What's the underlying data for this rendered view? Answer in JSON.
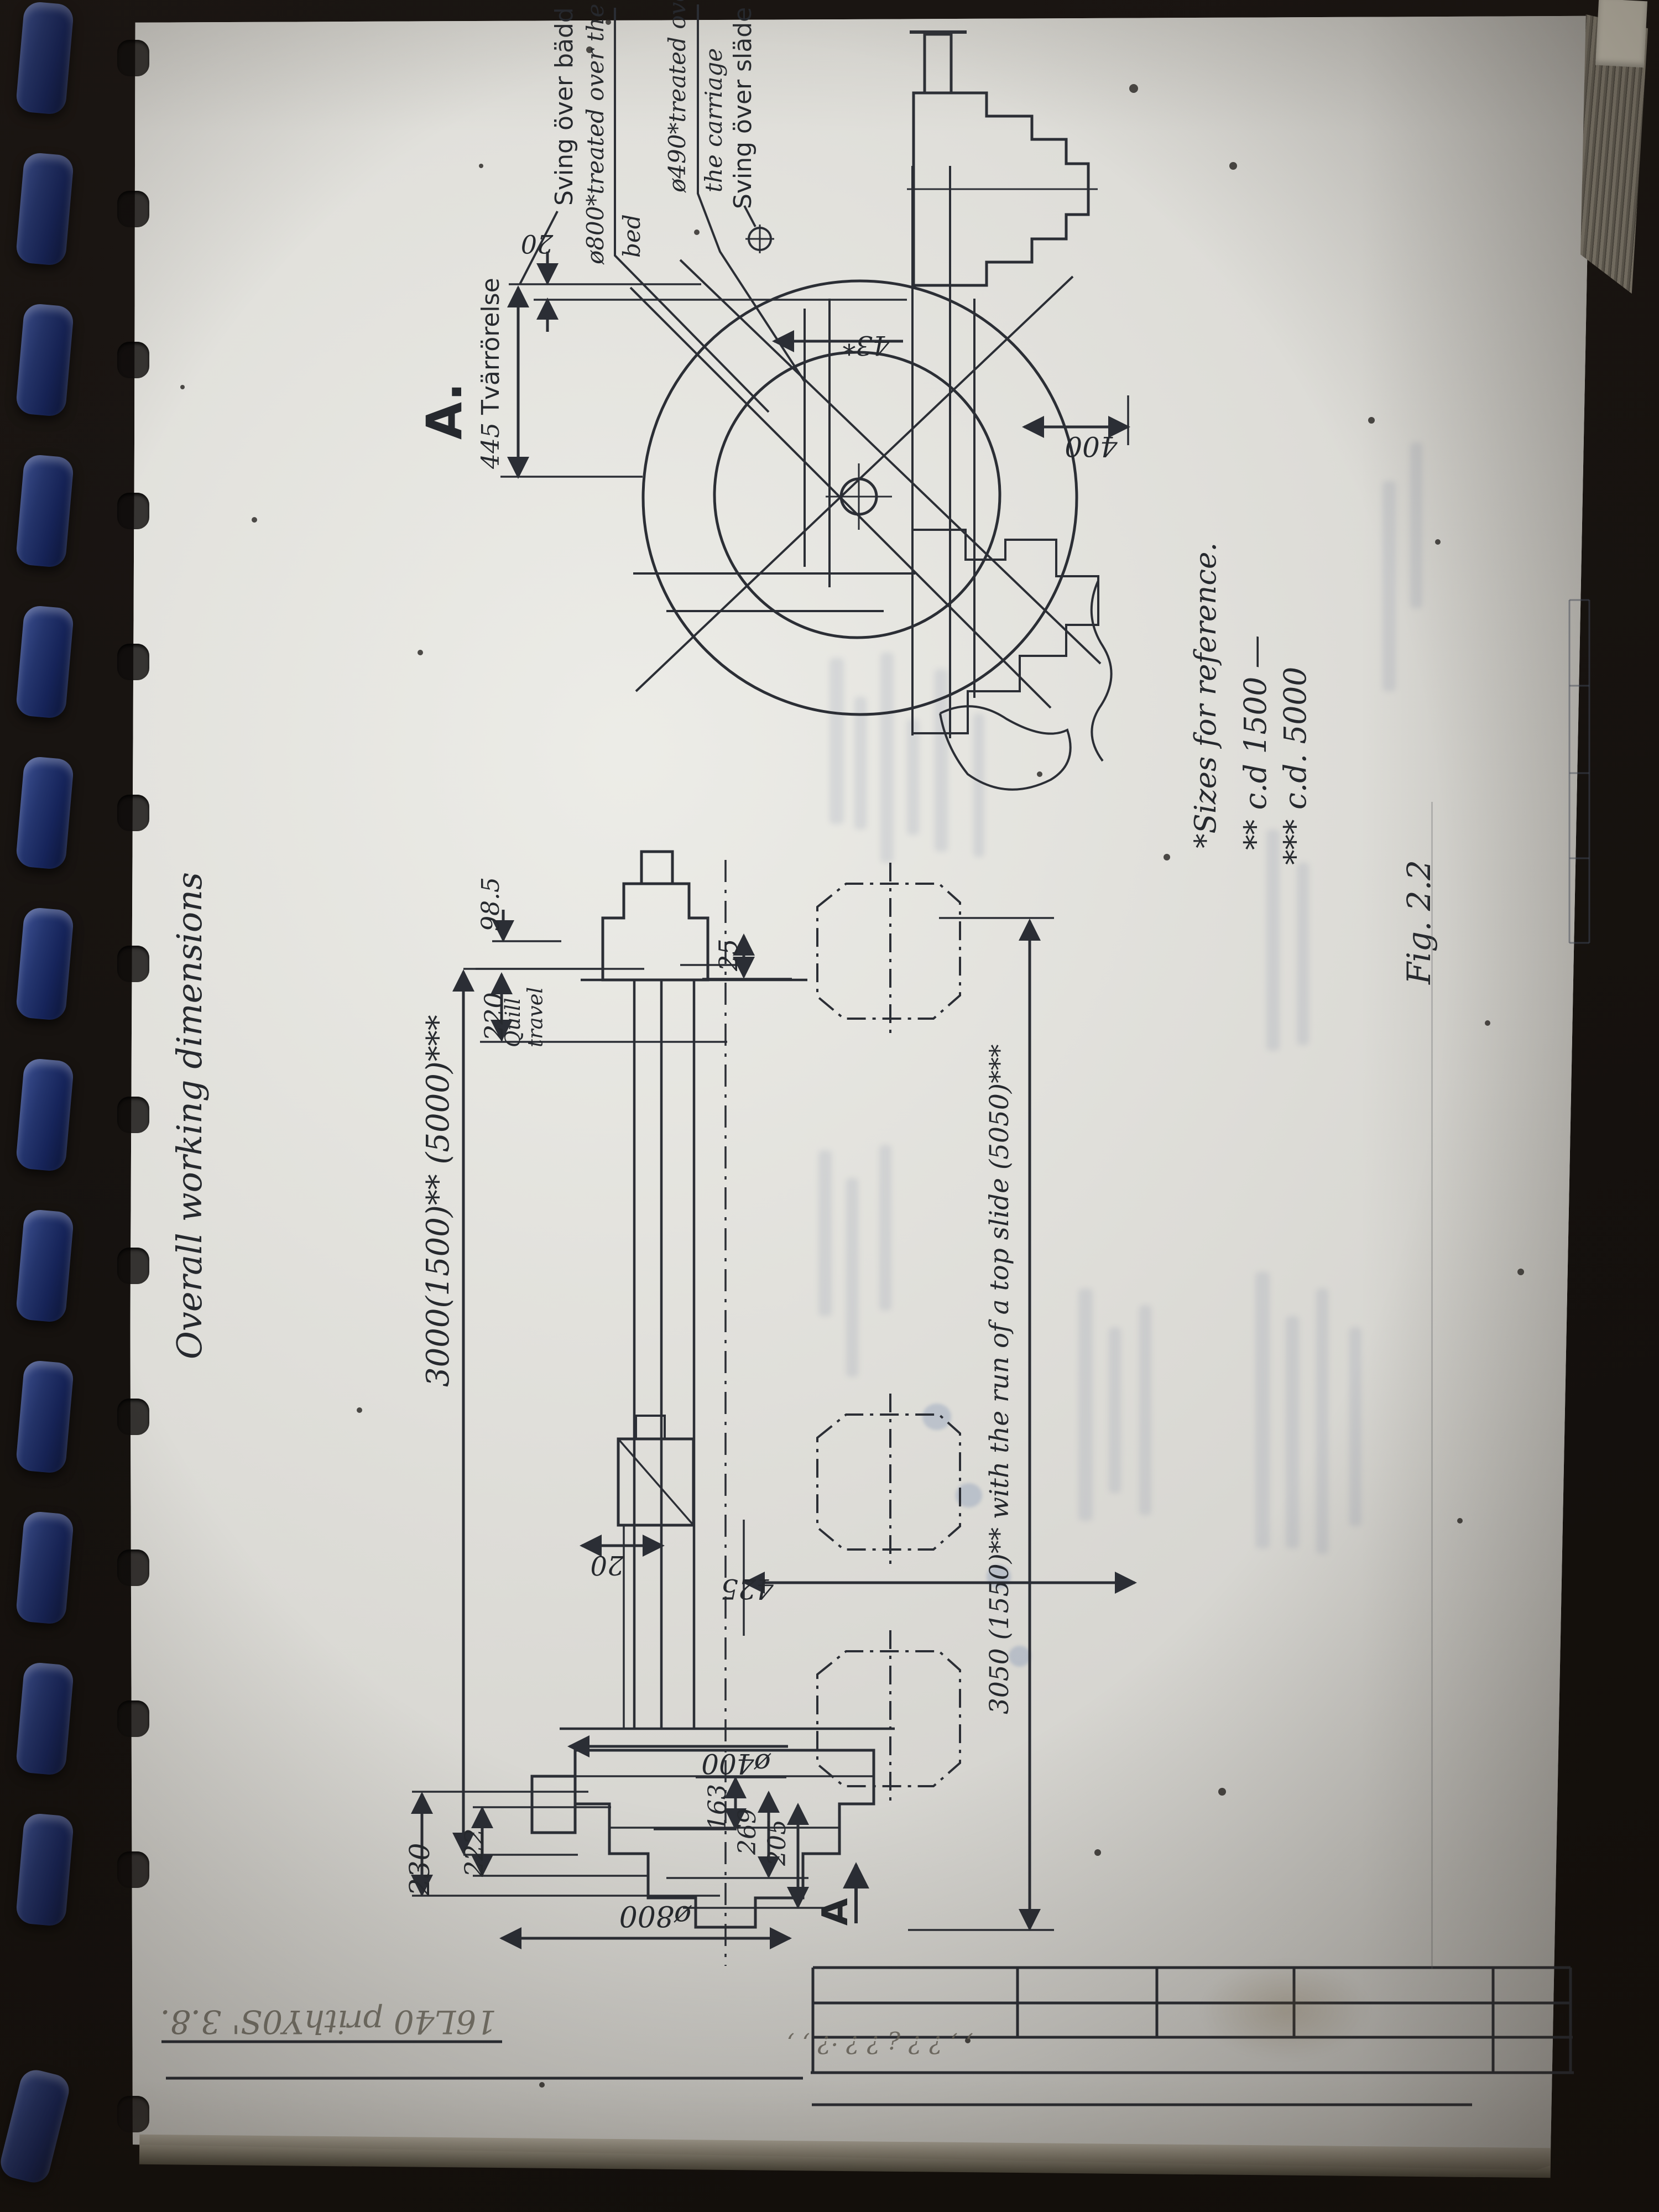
{
  "page": {
    "handwritten_title": "Overall working dimensions",
    "figure_caption": "Fig. 2.2",
    "pencil_note": "16L40  prithY0S'  3.8.",
    "pencil_scribbles": "‚ ‚ ? ? ¿ ? ?   ·? ‚ ‚",
    "notes": {
      "ref": "*Sizes for reference.",
      "cd1500": "** c.d 1500 ―",
      "cd5000": "*** c.d. 5000"
    }
  },
  "end_view": {
    "label": "A.",
    "swing_over_bed_sv": "Sving över bädd",
    "swing_over_bed_en_1": "ø800*treated over the",
    "swing_over_bed_en_2": "bed",
    "swing_over_carriage_en_1": "ø490*treated over",
    "swing_over_carriage_en_2": "the carriage",
    "swing_over_slide_sv": "Sving över släde",
    "dim_cross_travel_value": "445",
    "dim_cross_travel_label": "Tvärrörelse",
    "dim_gap": "20",
    "dim_center": "43*",
    "dim_width": "400"
  },
  "side_view": {
    "dim_centers": "3000(1500)** (5000)***",
    "dim_top_slide": "3050 (1550)** with the run of a top slide (5050)***",
    "dim_quill_dia": "98.5",
    "dim_quill_travel_value": "220",
    "dim_quill_travel_label": "Quill travel",
    "dim_25": "25",
    "dim_20": "20",
    "dim_425": "425",
    "dim_230": "230",
    "dim_222": "222",
    "dim_163": "163",
    "dim_269": "269",
    "dim_205": "205",
    "dim_d400": "ø400",
    "dim_d800": "ø800",
    "section_label": "A"
  }
}
